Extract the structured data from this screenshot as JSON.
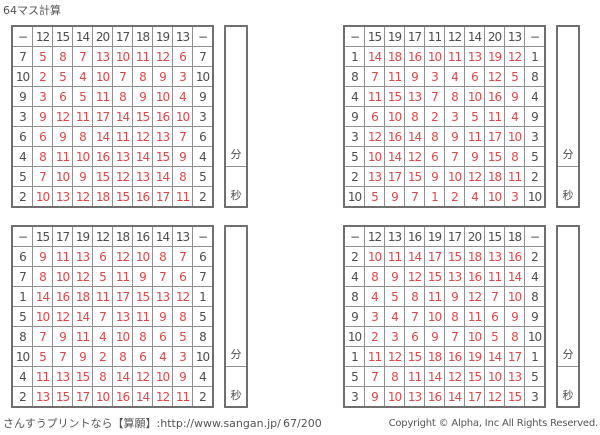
{
  "title": "64マス計算",
  "operator": "−",
  "time_box": {
    "minutes_label": "分",
    "seconds_label": "秒"
  },
  "footer": {
    "left": "さんすうプリントなら【算願】:http://www.sangan.jp/",
    "center": "67/200",
    "right": "Copyright © Alpha, Inc All Rights Reserved."
  },
  "colors": {
    "answer": "#e04848",
    "header_text": "#4d4d4d",
    "border_outer": "#6f6f6f",
    "border_inner": "#8f8f8f"
  },
  "grids": [
    {
      "position": "top-left",
      "col_headers": [
        12,
        15,
        14,
        20,
        17,
        18,
        19,
        13
      ],
      "row_headers": [
        7,
        10,
        9,
        3,
        6,
        4,
        5,
        2
      ],
      "answers": [
        [
          5,
          8,
          7,
          13,
          10,
          11,
          12,
          6
        ],
        [
          2,
          5,
          4,
          10,
          7,
          8,
          9,
          3
        ],
        [
          3,
          6,
          5,
          11,
          8,
          9,
          10,
          4
        ],
        [
          9,
          12,
          11,
          17,
          14,
          15,
          16,
          10
        ],
        [
          6,
          9,
          8,
          14,
          11,
          12,
          13,
          7
        ],
        [
          8,
          11,
          10,
          16,
          13,
          14,
          15,
          9
        ],
        [
          7,
          10,
          9,
          15,
          12,
          13,
          14,
          8
        ],
        [
          10,
          13,
          12,
          18,
          15,
          16,
          17,
          11
        ]
      ]
    },
    {
      "position": "top-right",
      "col_headers": [
        15,
        19,
        17,
        11,
        12,
        14,
        20,
        13
      ],
      "row_headers": [
        1,
        8,
        4,
        9,
        3,
        5,
        2,
        10
      ],
      "answers": [
        [
          14,
          18,
          16,
          10,
          11,
          13,
          19,
          12
        ],
        [
          7,
          11,
          9,
          3,
          4,
          6,
          12,
          5
        ],
        [
          11,
          15,
          13,
          7,
          8,
          10,
          16,
          9
        ],
        [
          6,
          10,
          8,
          2,
          3,
          5,
          11,
          4
        ],
        [
          12,
          16,
          14,
          8,
          9,
          11,
          17,
          10
        ],
        [
          10,
          14,
          12,
          6,
          7,
          9,
          15,
          8
        ],
        [
          13,
          17,
          15,
          9,
          10,
          12,
          18,
          11
        ],
        [
          5,
          9,
          7,
          1,
          2,
          4,
          10,
          3
        ]
      ]
    },
    {
      "position": "bottom-left",
      "col_headers": [
        15,
        17,
        19,
        12,
        18,
        16,
        14,
        13
      ],
      "row_headers": [
        6,
        7,
        1,
        5,
        8,
        10,
        4,
        2
      ],
      "answers": [
        [
          9,
          11,
          13,
          6,
          12,
          10,
          8,
          7
        ],
        [
          8,
          10,
          12,
          5,
          11,
          9,
          7,
          6
        ],
        [
          14,
          16,
          18,
          11,
          17,
          15,
          13,
          12
        ],
        [
          10,
          12,
          14,
          7,
          13,
          11,
          9,
          8
        ],
        [
          7,
          9,
          11,
          4,
          10,
          8,
          6,
          5
        ],
        [
          5,
          7,
          9,
          2,
          8,
          6,
          4,
          3
        ],
        [
          11,
          13,
          15,
          8,
          14,
          12,
          10,
          9
        ],
        [
          13,
          15,
          17,
          10,
          16,
          14,
          12,
          11
        ]
      ]
    },
    {
      "position": "bottom-right",
      "col_headers": [
        12,
        13,
        16,
        19,
        17,
        20,
        15,
        18
      ],
      "row_headers": [
        2,
        4,
        8,
        9,
        10,
        1,
        5,
        3
      ],
      "answers": [
        [
          10,
          11,
          14,
          17,
          15,
          18,
          13,
          16
        ],
        [
          8,
          9,
          12,
          15,
          13,
          16,
          11,
          14
        ],
        [
          4,
          5,
          8,
          11,
          9,
          12,
          7,
          10
        ],
        [
          3,
          4,
          7,
          10,
          8,
          11,
          6,
          9
        ],
        [
          2,
          3,
          6,
          9,
          7,
          10,
          5,
          8
        ],
        [
          11,
          12,
          15,
          18,
          16,
          19,
          14,
          17
        ],
        [
          7,
          8,
          11,
          14,
          12,
          15,
          10,
          13
        ],
        [
          9,
          10,
          13,
          16,
          14,
          17,
          12,
          15
        ]
      ]
    }
  ]
}
